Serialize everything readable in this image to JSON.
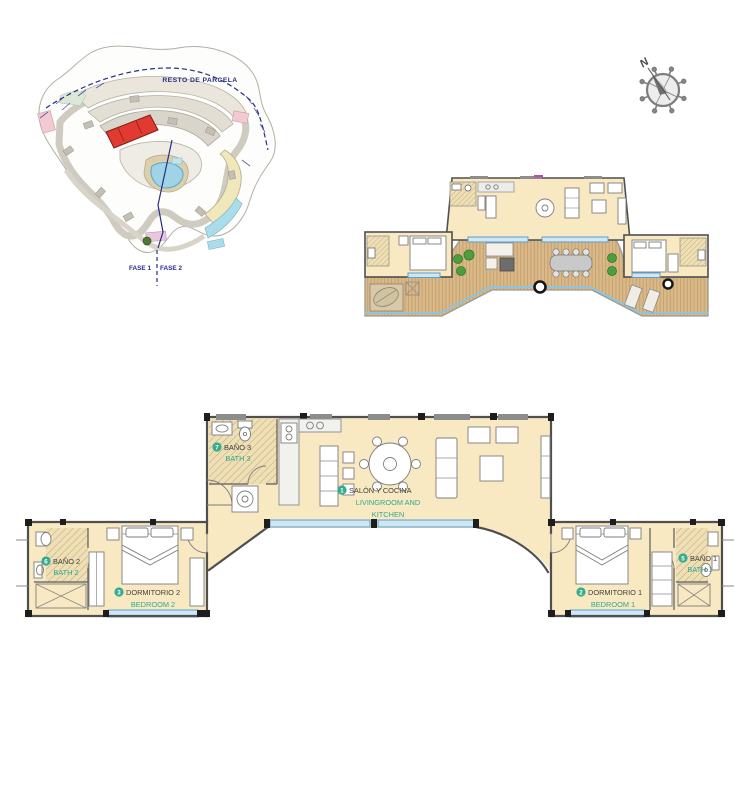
{
  "site_plan": {
    "title_label": "RESTO DE PARCELA",
    "phase1_label": "FASE 1",
    "phase2_label": "FASE 2"
  },
  "compass": {
    "north_label": "N"
  },
  "main_plan": {
    "rooms": [
      {
        "number": "1",
        "name_es": "SALÓN Y COCINA",
        "en1": "LIVINGROOM AND",
        "en2": "KITCHEN"
      },
      {
        "number": "2",
        "name_es": "DORMITORIO 1",
        "en1": "BEDROOM 1"
      },
      {
        "number": "3",
        "name_es": "DORMITORIO 2",
        "en1": "BEDROOM 2"
      },
      {
        "number": "5",
        "name_es": "BAÑO 1",
        "en1": "BATH 1"
      },
      {
        "number": "6",
        "name_es": "BAÑO 2",
        "en1": "BATH 2"
      },
      {
        "number": "7",
        "name_es": "BAÑO 3",
        "en1": "BATH 3"
      }
    ]
  },
  "palette": {
    "floor_cream": "#f8e9c2",
    "deck_wood": "#d9b98a",
    "wall_gray": "#4f4f4f",
    "window_blue": "#cfe6f4",
    "window_blue_line": "#5f9fc8",
    "label_teal": "#2fa890",
    "label_dark": "#3f3f3f",
    "badge_green": "#35ab8f",
    "site_red": "#e03a31",
    "site_pool_blue": "#9fd3e6",
    "site_navy": "#2a2d85",
    "site_yellow": "#f0e7ba",
    "site_pink": "#f3c9d2",
    "site_cyan": "#aadce9"
  }
}
